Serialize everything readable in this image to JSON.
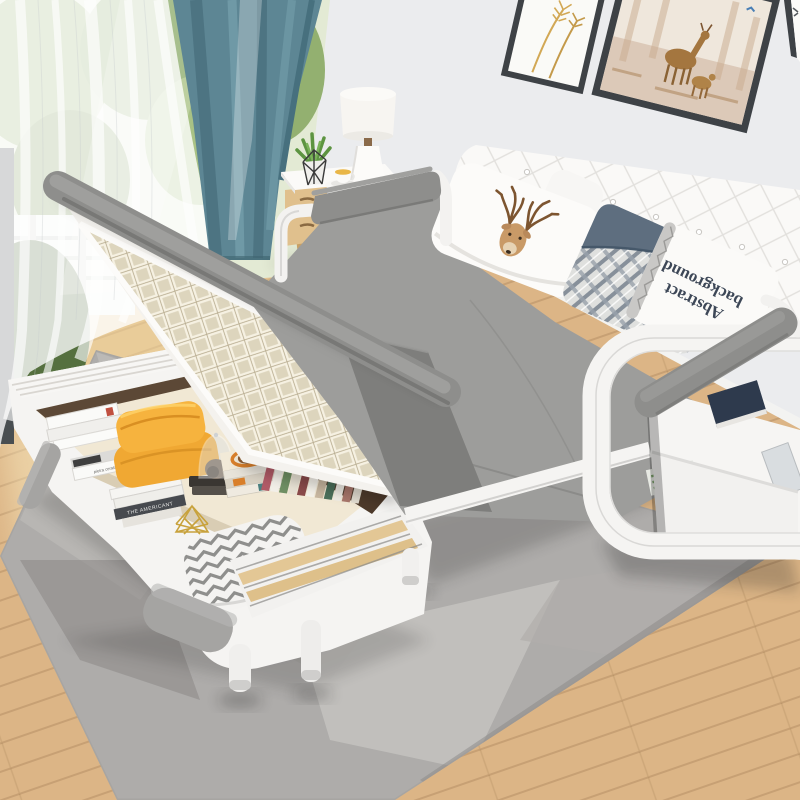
{
  "scene": {
    "type": "product-photo",
    "description": "White multifunctional sofa bed unfolded flat, under-seat storage box open and filled with books and cushions, in a bright bedroom with window, sheer and teal curtains, nightstand with lamp, wall art prints, grey geometric rug on warm oak flooring.",
    "pillow_text": {
      "line1": "Abstract",
      "line2": "background"
    },
    "book_spines": {
      "stack_label": "THE AMERICANT",
      "small_label": "pietra cerata"
    },
    "palette": {
      "wall": "#ebecee",
      "baseboard": "#f5f5f3",
      "wood_floor": "#dcb586",
      "rug_base": "#aeacaa",
      "sheer": "#ffffff",
      "teal_curtain": "#5d8694",
      "window_frame": "#494e51",
      "art_frame": "#3e4246",
      "nightstand_white": "#f6f5f3",
      "nightstand_wood": "#e0c08d",
      "lamp_white": "#f7f5f1",
      "headboard_white": "#faf9f7",
      "mattress_gray": "#9d9d9b",
      "mattress_side": "#7e7e7c",
      "armrest_pad_gray": "#8e8e8c",
      "frame_white": "#f5f4f2",
      "pocket_white": "#f6f5f3",
      "navy_book": "#2e3a4d",
      "yellow_pillow": "#f6b33e",
      "blue_pillow": "#5e6e7f",
      "lid_frame_white": "#f4f2ee",
      "lattice_cream": "#e6dfca",
      "storage_floor": "#f1e8d4",
      "storage_wall_brown": "#5c4836",
      "chevron_white": "#f4f3f1",
      "base_white": "#f5f4f2",
      "inset_gray": "#a5a4a2"
    },
    "visible_objects": [
      "sheer white curtain",
      "teal curtain",
      "window with garden view",
      "white nightstand with wood drawers",
      "white table lamp",
      "succulent in wire planter",
      "cup and saucer",
      "framed wheat print",
      "framed deer print",
      "partially visible third frame",
      "white tufted headboard",
      "deer print pillow",
      "slate blue plaid pillow",
      "white pillow with rotated Abstract background text",
      "gray sofa-bed mattress",
      "gray padded armrest bars",
      "white curved armrest frame with magazine pockets",
      "open under-seat storage box",
      "raised slatted lid",
      "yellow cushions",
      "glass cloche with stones",
      "book and magazine stacks",
      "row of standing books",
      "gold wire basket",
      "zigzag chevron cushion",
      "white base with gray insets and round legs",
      "gray geometric area rug",
      "light oak wood floor"
    ]
  }
}
